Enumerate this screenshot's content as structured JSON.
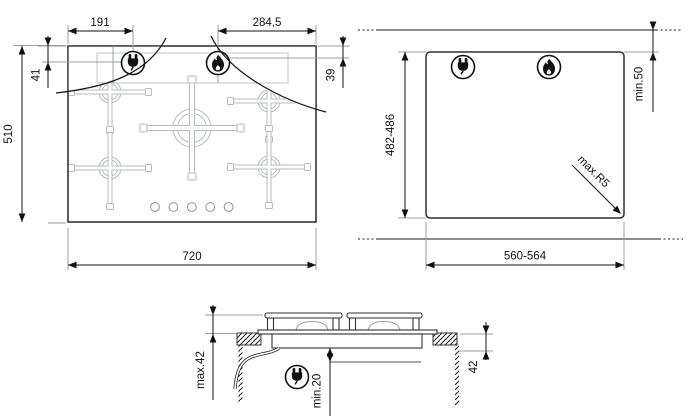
{
  "top_view": {
    "plug_from_left": "191",
    "flame_from_right": "284,5",
    "plug_from_top": "41",
    "flame_from_top": "39",
    "height": "510",
    "width": "720"
  },
  "cutout_view": {
    "height_range": "482-486",
    "width_range": "560-564",
    "rear_clearance": "min.50",
    "corner_radius": "max.R5"
  },
  "side_view": {
    "height_above_worktop": "max.42",
    "clearance_below": "min.20",
    "recess_depth": "42"
  },
  "icons": {
    "plug": "electrical-connection-point",
    "flame": "gas-connection-point"
  },
  "colors": {
    "line": "#1a1a1a",
    "ext_line": "#9aa0a2",
    "zone_line": "#c3c6c7",
    "burner": "#b9bcbd",
    "knob": "#8f9698"
  }
}
